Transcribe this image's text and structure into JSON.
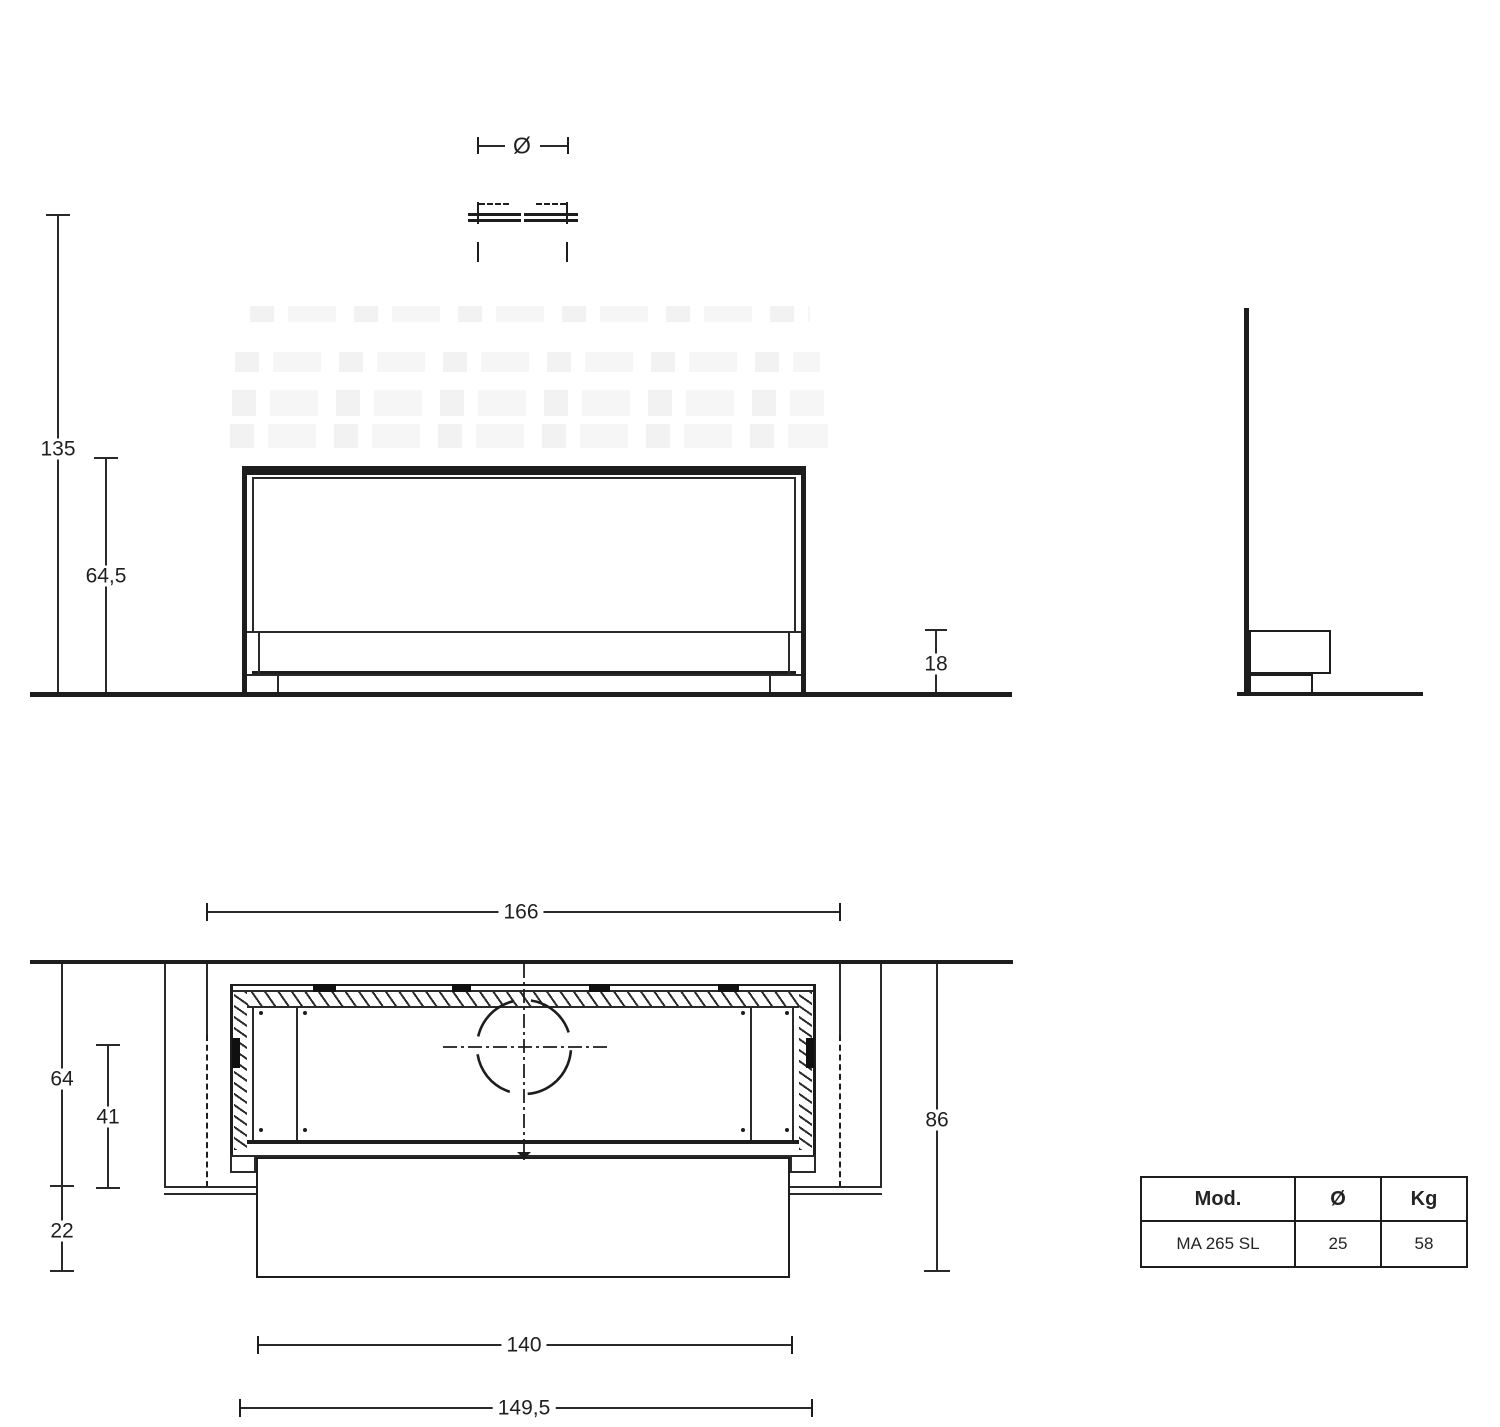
{
  "style": {
    "background": "#ffffff",
    "line_color": "#1d1d1d",
    "dim_text_color": "#1f1f1f"
  },
  "flue_symbol": {
    "diameter_label": "Ø"
  },
  "front_view": {
    "dim_total_height": "135",
    "dim_firebox_height": "64,5",
    "dim_base_height": "18"
  },
  "plan_view": {
    "dim_recess_width": "166",
    "dim_depth_total": "64",
    "dim_depth_inner": "41",
    "dim_front_projection": "22",
    "dim_recess_span": "86",
    "dim_inner_width": "140",
    "dim_front_width": "149,5"
  },
  "spec_table": {
    "headers": [
      "Mod.",
      "Ø",
      "Kg"
    ],
    "row": [
      "MA 265 SL",
      "25",
      "58"
    ]
  }
}
